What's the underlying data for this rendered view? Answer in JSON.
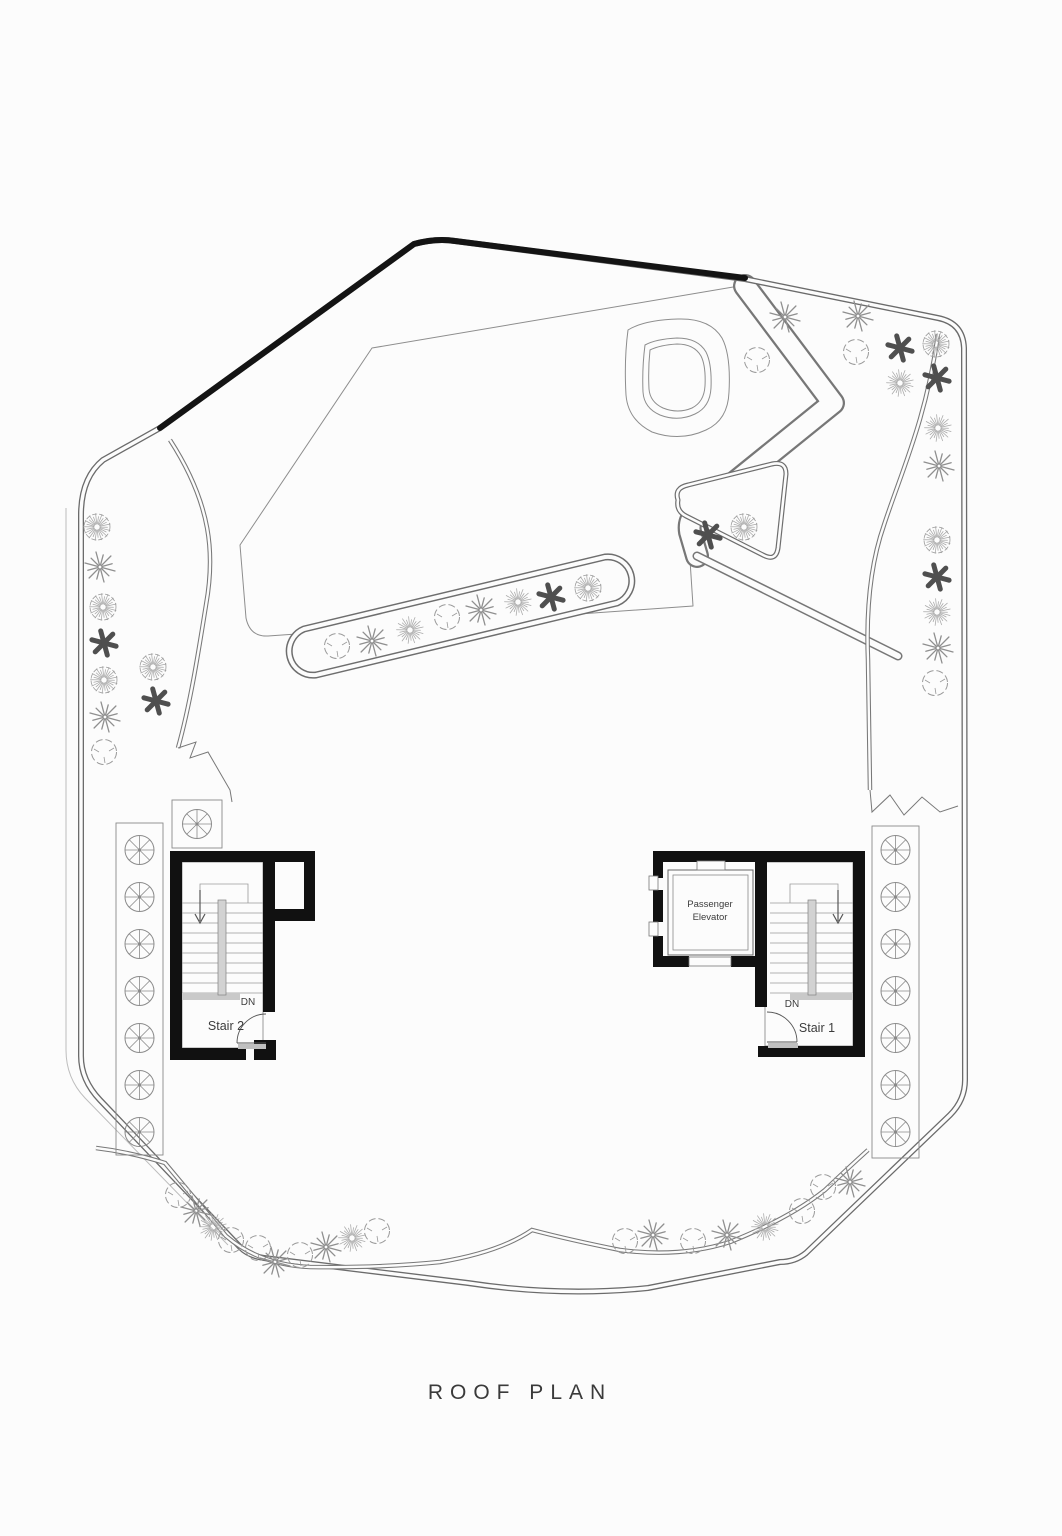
{
  "drawing": {
    "title": "ROOF PLAN",
    "type": "architectural roof plan"
  },
  "labels": {
    "title": "ROOF PLAN",
    "stair1": "Stair 1",
    "stair2": "Stair 2",
    "dn_left": "DN",
    "dn_right": "DN",
    "elevator_line1": "Passenger",
    "elevator_line2": "Elevator"
  },
  "palette": {
    "paper": "#fcfcfc",
    "wall_black": "#111111",
    "parapet_edge": "#141414",
    "thin_line": "#6b6b6b",
    "kerb_line": "#787878",
    "plant_light": "#a8a8a8",
    "plant_mid": "#8f8f8f",
    "plant_dark": "#4f4f4f",
    "tread_gray": "#c9c9c9"
  },
  "equipment": {
    "left_fan_row": {
      "cx": 139.5,
      "cys": [
        850,
        897,
        944,
        991,
        1038,
        1085,
        1132
      ]
    },
    "right_fan_row": {
      "cx": 895.5,
      "cys": [
        850,
        897,
        944,
        991,
        1038,
        1085,
        1132
      ]
    },
    "single_fan": {
      "cx": 197,
      "cy": 824
    }
  },
  "plants": [
    {
      "type": "texcircle",
      "x": 97,
      "y": 527
    },
    {
      "type": "spiky",
      "x": 100,
      "y": 567
    },
    {
      "type": "texcircle",
      "x": 103,
      "y": 607
    },
    {
      "type": "aster",
      "x": 104,
      "y": 643
    },
    {
      "type": "texcircle",
      "x": 104,
      "y": 680
    },
    {
      "type": "spiky",
      "x": 105,
      "y": 717
    },
    {
      "type": "scallop",
      "x": 104,
      "y": 752
    },
    {
      "type": "texcircle",
      "x": 153,
      "y": 667
    },
    {
      "type": "aster",
      "x": 156,
      "y": 701
    },
    {
      "type": "spiky",
      "x": 785,
      "y": 317
    },
    {
      "type": "scallop",
      "x": 757,
      "y": 360
    },
    {
      "type": "spiky",
      "x": 858,
      "y": 316
    },
    {
      "type": "scallop",
      "x": 856,
      "y": 352
    },
    {
      "type": "aster",
      "x": 900,
      "y": 348
    },
    {
      "type": "texcircle",
      "x": 936,
      "y": 344
    },
    {
      "type": "fluffy",
      "x": 900,
      "y": 383
    },
    {
      "type": "aster",
      "x": 937,
      "y": 378
    },
    {
      "type": "fluffy",
      "x": 938,
      "y": 428
    },
    {
      "type": "spiky",
      "x": 939,
      "y": 466
    },
    {
      "type": "texcircle",
      "x": 937,
      "y": 540
    },
    {
      "type": "aster",
      "x": 937,
      "y": 577
    },
    {
      "type": "fluffy",
      "x": 937,
      "y": 612
    },
    {
      "type": "spiky",
      "x": 938,
      "y": 648
    },
    {
      "type": "scallop",
      "x": 935,
      "y": 683
    },
    {
      "type": "scallop",
      "x": 337,
      "y": 646
    },
    {
      "type": "spiky",
      "x": 372,
      "y": 641
    },
    {
      "type": "fluffy",
      "x": 410,
      "y": 630
    },
    {
      "type": "scallop",
      "x": 447,
      "y": 617
    },
    {
      "type": "spiky",
      "x": 481,
      "y": 610
    },
    {
      "type": "fluffy",
      "x": 518,
      "y": 602
    },
    {
      "type": "aster",
      "x": 551,
      "y": 597
    },
    {
      "type": "texcircle",
      "x": 588,
      "y": 588
    },
    {
      "type": "aster",
      "x": 708,
      "y": 535
    },
    {
      "type": "texcircle",
      "x": 744,
      "y": 527
    },
    {
      "type": "scallop",
      "x": 178,
      "y": 1195
    },
    {
      "type": "spiky",
      "x": 196,
      "y": 1211
    },
    {
      "type": "fluffy",
      "x": 213,
      "y": 1227
    },
    {
      "type": "scallop",
      "x": 231,
      "y": 1240
    },
    {
      "type": "scallop",
      "x": 258,
      "y": 1248
    },
    {
      "type": "spiky",
      "x": 275,
      "y": 1262
    },
    {
      "type": "scallop",
      "x": 300,
      "y": 1255
    },
    {
      "type": "spiky",
      "x": 326,
      "y": 1247
    },
    {
      "type": "fluffy",
      "x": 352,
      "y": 1238
    },
    {
      "type": "scallop",
      "x": 377,
      "y": 1231
    },
    {
      "type": "scallop",
      "x": 625,
      "y": 1241
    },
    {
      "type": "spiky",
      "x": 653,
      "y": 1235
    },
    {
      "type": "scallop",
      "x": 693,
      "y": 1241
    },
    {
      "type": "spiky",
      "x": 727,
      "y": 1235
    },
    {
      "type": "fluffy",
      "x": 765,
      "y": 1227
    },
    {
      "type": "scallop",
      "x": 802,
      "y": 1211
    },
    {
      "type": "scallop",
      "x": 823,
      "y": 1187
    },
    {
      "type": "spiky",
      "x": 850,
      "y": 1182
    }
  ]
}
